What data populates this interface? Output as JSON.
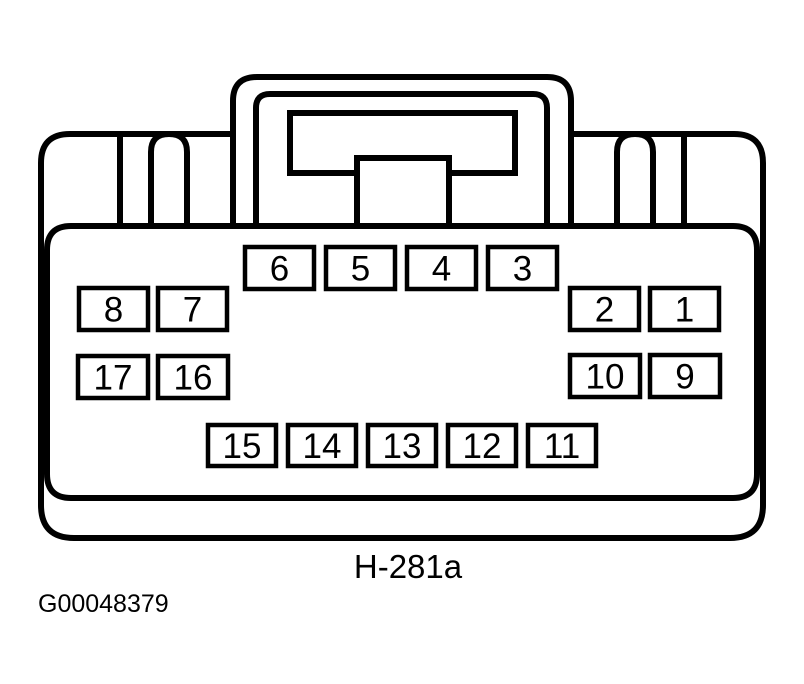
{
  "diagram": {
    "type": "connector-pinout",
    "connector_label": "H-281a",
    "figure_id": "G00048379",
    "ink_color": "#000000",
    "background_color": "#ffffff",
    "pin_rows": [
      {
        "position": "top-center",
        "pins": [
          "6",
          "5",
          "4",
          "3"
        ]
      },
      {
        "position": "upper-left",
        "pins": [
          "8",
          "7"
        ]
      },
      {
        "position": "upper-right",
        "pins": [
          "2",
          "1"
        ]
      },
      {
        "position": "mid-left",
        "pins": [
          "17",
          "16"
        ]
      },
      {
        "position": "mid-right",
        "pins": [
          "10",
          "9"
        ]
      },
      {
        "position": "bottom-center",
        "pins": [
          "15",
          "14",
          "13",
          "12",
          "11"
        ]
      }
    ]
  }
}
